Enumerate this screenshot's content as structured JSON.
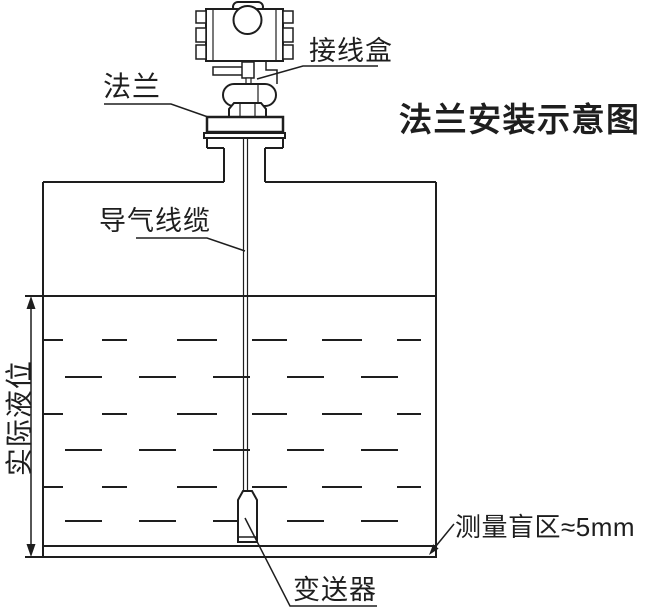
{
  "diagram": {
    "title": "法兰安装示意图",
    "labels": {
      "junction_box": "接线盒",
      "flange": "法兰",
      "air_guide_cable": "导气线缆",
      "actual_liquid_level": "实际液位",
      "blind_zone": "测量盲区≈5mm",
      "transmitter": "变送器"
    },
    "colors": {
      "line": "#1e1e1e",
      "background": "#ffffff"
    }
  }
}
